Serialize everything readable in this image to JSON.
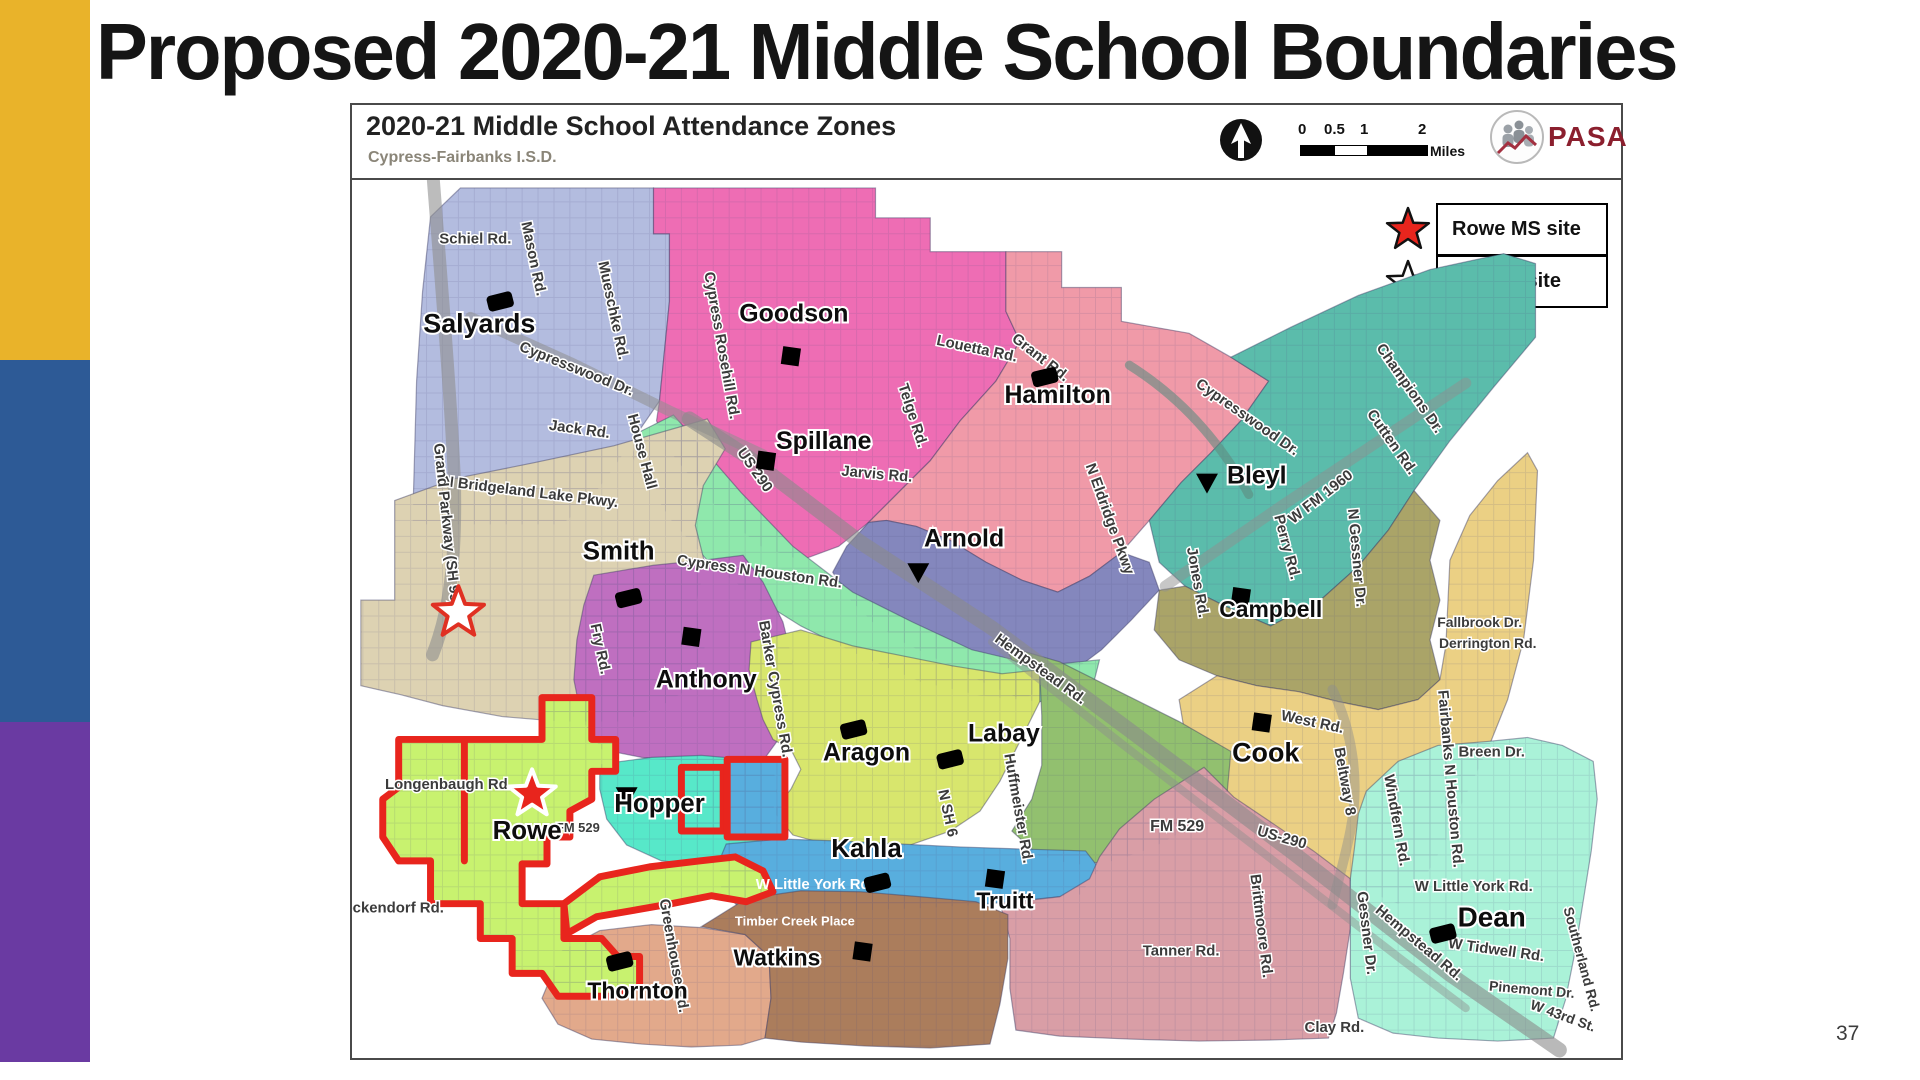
{
  "slide": {
    "title": "Proposed 2020-21 Middle School Boundaries",
    "page_number": "37"
  },
  "sidebar": {
    "stripes": [
      {
        "name": "gold",
        "color": "#e9b32a"
      },
      {
        "name": "blue",
        "color": "#2d5a96"
      },
      {
        "name": "purple",
        "color": "#6a3aa2"
      }
    ]
  },
  "map": {
    "header": {
      "title": "2020-21 Middle School Attendance Zones",
      "subtitle": "Cypress-Fairbanks I.S.D.",
      "scale": {
        "labels": [
          "0",
          "0.5",
          "1",
          "2"
        ],
        "unit": "Miles"
      },
      "logo_text": "PASA",
      "logo_color": "#8b1f2e"
    },
    "legend": [
      {
        "symbol": "red-star",
        "label": "Rowe MS site"
      },
      {
        "symbol": "white-star",
        "label": "MS #20 site"
      }
    ],
    "boundary_color": "#e8251d",
    "zones": [
      {
        "name": "Salyards",
        "color": "#b3bcdf",
        "points": "428,215 458,186 652,186 652,232 668,232 668,300 658,400 636,432 610,470 586,502 560,524 470,524 410,524 414,380 420,290"
      },
      {
        "name": "Goodson",
        "color": "#ee6db4",
        "points": "652,186 875,186 875,216 930,216 930,250 1006,250 1006,310 1020,340 996,380 960,420 930,460 900,490 868,522 838,546 800,560 760,546 728,520 700,490 672,455 655,420 658,400 668,300 668,232 652,232"
      },
      {
        "name": "Hamilton",
        "color": "#f09aa8",
        "points": "1006,250 1062,250 1062,286 1122,286 1122,320 1190,332 1232,356 1270,380 1242,420 1212,452 1182,482 1150,520 1122,552 1090,576 1058,592 1022,580 986,562 950,540 916,526 886,520 868,522 900,490 930,460 960,420 996,380 1020,340 1006,310"
      },
      {
        "name": "Bleyl",
        "color": "#5bbcab",
        "points": "1232,356 1292,326 1360,294 1432,268 1506,252 1538,262 1538,336 1496,386 1452,440 1416,490 1390,530 1360,566 1322,600 1272,626 1226,606 1186,586 1160,562 1150,520 1182,482 1212,452 1242,420 1270,380"
      },
      {
        "name": "Arnold",
        "color": "#8487bd",
        "points": "868,522 886,520 916,526 950,540 986,562 1022,580 1058,592 1090,576 1122,552 1150,562 1160,590 1132,620 1102,650 1062,680 1022,700 982,682 942,662 902,642 872,622 850,600 832,572 846,546"
      },
      {
        "name": "Spillane",
        "color": "#8fe8ac",
        "points": "640,430 672,414 700,446 740,492 792,546 852,592 912,622 972,650 1040,666 1100,660 1092,692 1040,702 980,696 920,682 860,656 800,626 752,596 706,560 670,520 644,480 630,455"
      },
      {
        "name": "Smith",
        "color": "#ddd2b2",
        "points": "358,650 358,600 392,600 392,500 452,478 532,462 612,445 682,425 706,418 724,448 702,485 694,525 704,565 694,605 704,645 694,685 660,706 620,722 560,722 500,717 440,706 398,695 358,686"
      },
      {
        "name": "Campbell",
        "color": "#aaa468",
        "points": "1160,590 1186,586 1226,606 1272,626 1322,600 1360,566 1390,530 1416,490 1442,520 1432,560 1442,600 1432,640 1442,680 1420,700 1380,710 1340,702 1300,692 1258,686 1218,676 1180,660 1155,630"
      },
      {
        "name": "Cook",
        "color": "#ebd084",
        "points": "1185,730 1180,700 1218,676 1258,686 1300,692 1340,702 1380,710 1420,700 1442,680 1448,645 1452,560 1472,515 1500,480 1530,452 1540,470 1536,560 1526,640 1510,700 1490,750 1466,800 1446,845 1426,880 1400,905 1370,893 1336,872 1300,848 1266,822 1230,795 1205,765"
      },
      {
        "name": "Anthony",
        "color": "#bf6fc0",
        "points": "592,575 652,565 702,560 742,555 762,582 782,622 792,662 786,702 776,742 760,764 720,766 680,762 640,758 600,750 580,720 572,680 575,640 582,605"
      },
      {
        "name": "Aragon",
        "color": "#d8e66d",
        "points": "750,642 800,630 852,646 902,656 952,666 1002,674 1040,670 1040,702 1020,742 1000,782 980,812 950,832 910,846 868,852 828,846 792,836 772,812 790,790 800,770 790,750 772,740 762,720 756,700 748,670"
      },
      {
        "name": "Labay",
        "color": "#92c06f",
        "points": "1005,646 1060,662 1120,692 1180,722 1232,752 1228,796 1195,826 1155,848 1115,862 1075,866 1038,856 1012,832 1032,800 1042,766 1042,716 1040,672 1012,660"
      },
      {
        "name": "Hopper",
        "color": "#57e8c9",
        "points": "598,765 650,758 700,756 746,760 772,766 776,792 770,822 760,846 740,862 700,866 660,862 625,846 605,820 598,790"
      },
      {
        "name": "Hopper-annex",
        "color": "#57e8c9",
        "points": "680,768 722,768 722,832 680,832"
      },
      {
        "name": "Kahla-annex",
        "color": "#58aede",
        "points": "726,760 784,760 784,838 726,838"
      },
      {
        "name": "Kahla",
        "color": "#58aede",
        "points": "720,890 718,862 725,845 780,840 840,842 900,845 960,848 1020,850 1086,852 1100,870 1080,896 1030,901 980,906 930,909 880,911 830,913 780,916 740,911"
      },
      {
        "name": "Truitt",
        "color": "#d99ea6",
        "points": "1000,905 1010,940 1010,990 1016,1032 1060,1038 1130,1041 1200,1043 1270,1042 1330,1040 1338,1015 1345,975 1352,930 1352,880 1315,852 1275,825 1235,798 1205,768 1155,800 1120,830 1100,858 1090,880 1060,898"
      },
      {
        "name": "Dean",
        "color": "#aaf2d8",
        "points": "1368,792 1400,762 1440,746 1490,742 1530,738 1565,746 1596,762 1600,800 1594,852 1586,902 1578,952 1568,1002 1556,1040 1500,1043 1440,1040 1395,1035 1360,1020 1352,980 1352,880 1356,850 1360,815"
      },
      {
        "name": "Thornton",
        "color": "#e2a98b",
        "points": "540,1000 560,952 598,932 650,926 700,929 744,936 768,958 770,1000 764,1040 740,1047 690,1049 640,1046 590,1041 556,1026"
      },
      {
        "name": "Watkins",
        "color": "#ab7d5c",
        "points": "700,928 745,900 800,892 860,893 920,898 976,903 1008,916 1008,960 1000,1006 990,1046 930,1050 865,1048 800,1044 764,1040 770,1000 768,958 744,936"
      },
      {
        "name": "Rowe",
        "color": "#c8f26f",
        "points": "396,740 540,740 540,698 590,698 590,740 614,740 614,772 590,772 590,800 568,812 568,838 545,838 545,865 520,865 520,905 562,905 562,940 600,940 616,958 638,958 638,988 610,998 556,998 540,975 510,975 510,940 478,940 478,905 428,905 428,862 396,862 380,838 380,800 396,788"
      },
      {
        "name": "Rowe-lobe",
        "color": "#c8f26f",
        "points": "562,905 598,878 648,868 698,862 734,858 762,872 772,893 745,903 710,897 670,905 630,912 595,918 565,935"
      }
    ],
    "highways": [
      {
        "name": "Grand Parkway SH 99",
        "d": "M 428,142 C 438,270 448,390 452,480 C 454,565 446,615 430,655",
        "w": 13,
        "c": "#8f8f8f",
        "o": 0.6
      },
      {
        "name": "Cypresswood Dr W",
        "d": "M 468,316 L 570,362 L 668,410 L 762,454",
        "w": 11,
        "c": "#8f8f8f",
        "o": 0.55
      },
      {
        "name": "US 290",
        "d": "M 688,418 L 745,455 L 860,542 L 992,628 L 1132,732 L 1292,852 L 1452,976 L 1562,1052",
        "w": 15,
        "c": "#8a8a8a",
        "o": 0.6
      },
      {
        "name": "Hempstead Rd",
        "d": "M 992,642 L 1122,744 L 1262,852 L 1402,960 L 1468,1010",
        "w": 8,
        "c": "#8f8f8f",
        "o": 0.45
      },
      {
        "name": "Cypresswood Dr E",
        "d": "M 1130,364 C 1184,398 1222,442 1250,494",
        "w": 9,
        "c": "#5f8c80",
        "o": 0.6
      },
      {
        "name": "W FM 1960",
        "d": "M 1166,586 L 1282,506 L 1402,426 L 1468,382",
        "w": 11,
        "c": "#8f8f8f",
        "o": 0.5
      },
      {
        "name": "Beltway 8",
        "d": "M 1334,690 C 1354,732 1362,782 1352,832 C 1346,862 1338,888 1334,906",
        "w": 10,
        "c": "#8f8f8f",
        "o": 0.45
      }
    ],
    "red_boundary": [
      "M396,740 L540,740 L540,698 L590,698 L590,740 L614,740 L614,772 L590,772 L590,800 L568,812 L568,838 L545,838 L545,865 L520,865 L520,905 L562,905 L562,940 L600,940 L616,958 L638,958 L638,988 L610,998 L556,998 L540,975 L510,975 L510,940 L478,940 L478,905 L428,905 L428,862 L396,862 L380,838 L380,800 L396,788 Z",
      "M562,905 L598,878 L648,868 L698,862 L734,858 L762,872 L772,893 L745,903 L710,897 L670,905 L630,912 L595,918 L565,935 Z",
      "M680,768 L722,768 L722,832 L680,832 Z",
      "M726,760 L784,760 L784,838 L726,838 Z",
      "M462,742 L462,862"
    ],
    "schools": [
      {
        "t": "Salyards",
        "x": 477,
        "y": 331,
        "s": 27
      },
      {
        "t": "Goodson",
        "x": 793,
        "y": 320,
        "s": 25
      },
      {
        "t": "Hamilton",
        "x": 1058,
        "y": 402,
        "s": 25
      },
      {
        "t": "Spillane",
        "x": 823,
        "y": 448,
        "s": 25
      },
      {
        "t": "Bleyl",
        "x": 1258,
        "y": 483,
        "s": 25
      },
      {
        "t": "Arnold",
        "x": 964,
        "y": 546,
        "s": 25
      },
      {
        "t": "Smith",
        "x": 617,
        "y": 559,
        "s": 26
      },
      {
        "t": "Campbell",
        "x": 1272,
        "y": 617,
        "s": 23
      },
      {
        "t": "Anthony",
        "x": 705,
        "y": 688,
        "s": 25
      },
      {
        "t": "Aragon",
        "x": 866,
        "y": 761,
        "s": 25
      },
      {
        "t": "Labay",
        "x": 1004,
        "y": 742,
        "s": 25
      },
      {
        "t": "Cook",
        "x": 1267,
        "y": 762,
        "s": 27
      },
      {
        "t": "Hopper",
        "x": 658,
        "y": 813,
        "s": 26
      },
      {
        "t": "Rowe",
        "x": 525,
        "y": 840,
        "s": 26
      },
      {
        "t": "Kahla",
        "x": 866,
        "y": 858,
        "s": 26
      },
      {
        "t": "Truitt",
        "x": 1005,
        "y": 910,
        "s": 23
      },
      {
        "t": "Dean",
        "x": 1494,
        "y": 928,
        "s": 28
      },
      {
        "t": "Watkins",
        "x": 776,
        "y": 967,
        "s": 23
      },
      {
        "t": "Thornton",
        "x": 636,
        "y": 1000,
        "s": 23
      }
    ],
    "markers": [
      {
        "x": 498,
        "y": 300,
        "k": "blob"
      },
      {
        "x": 790,
        "y": 355,
        "k": "sq"
      },
      {
        "x": 1045,
        "y": 376,
        "k": "blob"
      },
      {
        "x": 765,
        "y": 460,
        "k": "sq"
      },
      {
        "x": 1208,
        "y": 482,
        "k": "tri"
      },
      {
        "x": 918,
        "y": 572,
        "k": "tri"
      },
      {
        "x": 627,
        "y": 598,
        "k": "blob"
      },
      {
        "x": 1242,
        "y": 597,
        "k": "sq"
      },
      {
        "x": 690,
        "y": 637,
        "k": "sq"
      },
      {
        "x": 853,
        "y": 730,
        "k": "blob"
      },
      {
        "x": 950,
        "y": 760,
        "k": "blob"
      },
      {
        "x": 1263,
        "y": 723,
        "k": "sq"
      },
      {
        "x": 625,
        "y": 797,
        "k": "tri"
      },
      {
        "x": 877,
        "y": 884,
        "k": "blob"
      },
      {
        "x": 995,
        "y": 880,
        "k": "sq"
      },
      {
        "x": 1445,
        "y": 935,
        "k": "blob"
      },
      {
        "x": 862,
        "y": 953,
        "k": "sq"
      },
      {
        "x": 618,
        "y": 963,
        "k": "blob"
      }
    ],
    "stars": [
      {
        "kind": "ms20-site",
        "x": 456,
        "y": 613,
        "r": 27,
        "fill": "#ffffff",
        "stroke": "#e03022"
      },
      {
        "kind": "rowe-site",
        "x": 530,
        "y": 795,
        "r": 25,
        "fill": "#e8251d",
        "stroke": "#ffffff"
      }
    ],
    "roads": [
      {
        "t": "Schiel Rd.",
        "x": 473,
        "y": 242,
        "r": 0
      },
      {
        "t": "Mason Rd.",
        "x": 527,
        "y": 258,
        "r": 78
      },
      {
        "t": "Mueschke Rd.",
        "x": 607,
        "y": 310,
        "r": 78
      },
      {
        "t": "Cypress Rosehill Rd.",
        "x": 716,
        "y": 345,
        "r": 80
      },
      {
        "t": "Cypresswood Dr.",
        "x": 573,
        "y": 372,
        "r": 22
      },
      {
        "t": "Jack Rd.",
        "x": 577,
        "y": 433,
        "r": 8
      },
      {
        "t": "House Hall",
        "x": 636,
        "y": 452,
        "r": 75
      },
      {
        "t": "Louetta Rd.",
        "x": 976,
        "y": 352,
        "r": 12
      },
      {
        "t": "Grant Rd.",
        "x": 1038,
        "y": 360,
        "r": 38
      },
      {
        "t": "Cypresswood Dr.",
        "x": 1246,
        "y": 420,
        "r": 35
      },
      {
        "t": "Champions Dr.",
        "x": 1408,
        "y": 390,
        "r": 55
      },
      {
        "t": "Cutten Rd.",
        "x": 1390,
        "y": 444,
        "r": 55
      },
      {
        "t": "Telge Rd.",
        "x": 908,
        "y": 416,
        "r": 72
      },
      {
        "t": "Jarvis Rd.",
        "x": 876,
        "y": 478,
        "r": 5
      },
      {
        "t": "US 290",
        "x": 750,
        "y": 472,
        "r": 55
      },
      {
        "t": "N Bridgeland Lake Pkwy.",
        "x": 528,
        "y": 496,
        "r": 7
      },
      {
        "t": "Grand Parkway (SH 99)",
        "x": 440,
        "y": 525,
        "r": 84
      },
      {
        "t": "Cypress N Houston Rd.",
        "x": 758,
        "y": 576,
        "r": 8
      },
      {
        "t": "Fry Rd.",
        "x": 594,
        "y": 650,
        "r": 78
      },
      {
        "t": "Barker Cypress Rd.",
        "x": 770,
        "y": 690,
        "r": 80
      },
      {
        "t": "N Eldridge Pkwy",
        "x": 1106,
        "y": 520,
        "r": 70
      },
      {
        "t": "Jones Rd.",
        "x": 1194,
        "y": 583,
        "r": 80
      },
      {
        "t": "Perry Rd.",
        "x": 1284,
        "y": 548,
        "r": 75
      },
      {
        "t": "W FM 1960",
        "x": 1325,
        "y": 500,
        "r": -38
      },
      {
        "t": "N Gessner Dr.",
        "x": 1354,
        "y": 558,
        "r": 85
      },
      {
        "t": "Hempstead Rd.",
        "x": 1038,
        "y": 673,
        "r": 36
      },
      {
        "t": "Fallbrook Dr.",
        "x": 1482,
        "y": 627,
        "r": 0,
        "s": 14
      },
      {
        "t": "Derrington Rd.",
        "x": 1490,
        "y": 648,
        "r": 0,
        "s": 14
      },
      {
        "t": "West Rd.",
        "x": 1313,
        "y": 727,
        "r": 12
      },
      {
        "t": "Beltway 8",
        "x": 1342,
        "y": 783,
        "r": 80
      },
      {
        "t": "Breen Dr.",
        "x": 1494,
        "y": 757,
        "r": 0
      },
      {
        "t": "Windfern Rd.",
        "x": 1394,
        "y": 822,
        "r": 80
      },
      {
        "t": "Fairbanks N Houston Rd.",
        "x": 1448,
        "y": 780,
        "r": 85
      },
      {
        "t": "FM 529",
        "x": 1178,
        "y": 832,
        "r": 0,
        "s": 16
      },
      {
        "t": "US-290",
        "x": 1282,
        "y": 843,
        "r": 16
      },
      {
        "t": "N SH 6",
        "x": 943,
        "y": 815,
        "r": 78
      },
      {
        "t": "Huffmeister Rd.",
        "x": 1014,
        "y": 810,
        "r": 80
      },
      {
        "t": "W Little York Rd.",
        "x": 814,
        "y": 890,
        "r": 0,
        "c": "#ffffff"
      },
      {
        "t": "Timber Creek Place",
        "x": 794,
        "y": 927,
        "r": 0,
        "c": "#ffffff",
        "s": 13
      },
      {
        "t": "W Little York Rd.",
        "x": 1476,
        "y": 892,
        "r": 0
      },
      {
        "t": "Tanner Rd.",
        "x": 1182,
        "y": 957,
        "r": 0
      },
      {
        "t": "Brittmoore Rd.",
        "x": 1258,
        "y": 928,
        "r": 83
      },
      {
        "t": "Gessner Dr.",
        "x": 1364,
        "y": 935,
        "r": 83
      },
      {
        "t": "Hempstead Rd.",
        "x": 1418,
        "y": 948,
        "r": 40
      },
      {
        "t": "W Tidwell Rd.",
        "x": 1498,
        "y": 956,
        "r": 8
      },
      {
        "t": "Pinemont Dr.",
        "x": 1534,
        "y": 996,
        "r": 5,
        "s": 14
      },
      {
        "t": "W 43rd St.",
        "x": 1564,
        "y": 1022,
        "r": 20,
        "s": 14
      },
      {
        "t": "Southerland Rd.",
        "x": 1580,
        "y": 962,
        "r": 75,
        "s": 14
      },
      {
        "t": "Clay Rd.",
        "x": 1336,
        "y": 1034,
        "r": 0
      },
      {
        "t": "Longenbaugh Rd.",
        "x": 446,
        "y": 790,
        "r": 0
      },
      {
        "t": "Beckendorf Rd.",
        "x": 386,
        "y": 914,
        "r": 0
      },
      {
        "t": "Greenhouse Rd.",
        "x": 668,
        "y": 958,
        "r": 80
      },
      {
        "t": "FM 529",
        "x": 576,
        "y": 833,
        "r": 0,
        "s": 13
      }
    ]
  }
}
